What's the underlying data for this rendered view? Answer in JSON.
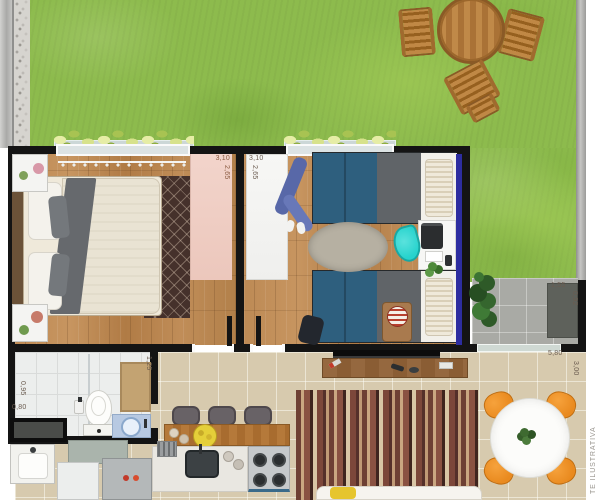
{
  "watermark": "TE ILUSTRATIVA",
  "labels": {
    "bedroom1_width": "3,10",
    "bedroom1_depth": "2,65",
    "bedroom2_width": "3,10",
    "bedroom2_depth": "2,65",
    "shower_depth": "0,95",
    "shower_width": "0,80",
    "bath_width": "1,25",
    "patio_width": "1,55",
    "patio_depth": "0,92",
    "living_width": "5,80",
    "living_depth": "3,00"
  },
  "colors": {
    "grass": "#8dbb4d",
    "wall": "#141414",
    "wood_floor": "#b8854f",
    "tile": "#d7caae",
    "patio_gray": "#a9aaa5",
    "pink_wardrobe": "#ecc7bc",
    "accent_blue_wall": "#2d2da0",
    "bed_blue": "#2e5f7e",
    "teal_chair": "#27d3cd",
    "orange_chair": "#e98a1f",
    "wood_furniture": "#b5793a"
  }
}
